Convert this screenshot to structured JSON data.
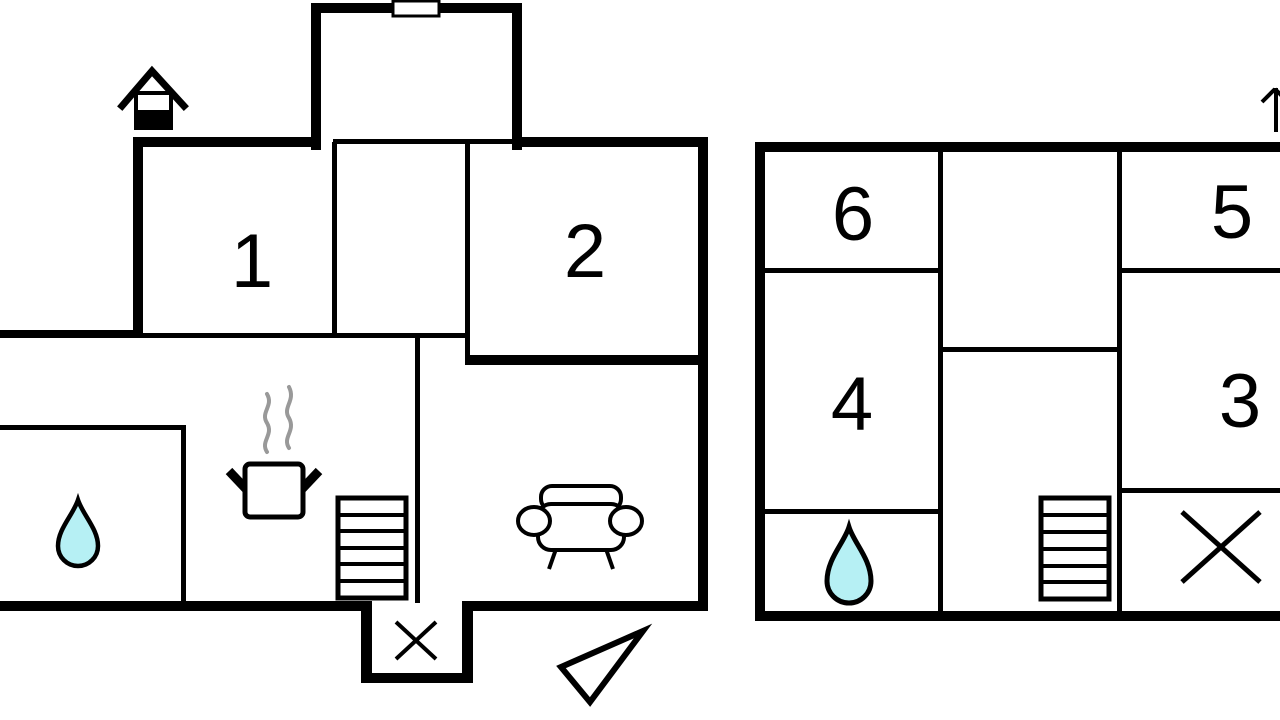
{
  "canvas": {
    "width": 1280,
    "height": 720,
    "background_color": "#ffffff",
    "wall_color": "#000000",
    "water_drop_color": "#b6f0f4",
    "steam_color": "#999999"
  },
  "ground_floor": {
    "rooms": [
      {
        "label": "1"
      },
      {
        "label": "2"
      }
    ],
    "icons": [
      "house-icon",
      "window-marker",
      "water-drop-icon",
      "pot-icon",
      "steam-icon",
      "stairs-icon",
      "sofa-icon",
      "entrance-cross-icon",
      "north-arrow-icon"
    ]
  },
  "upper_floor": {
    "rooms": [
      {
        "label": "6"
      },
      {
        "label": "5"
      },
      {
        "label": "4"
      },
      {
        "label": "3"
      }
    ],
    "icons": [
      "water-drop-icon",
      "stairs-icon",
      "cross-icon",
      "up-arrow-icon"
    ]
  }
}
